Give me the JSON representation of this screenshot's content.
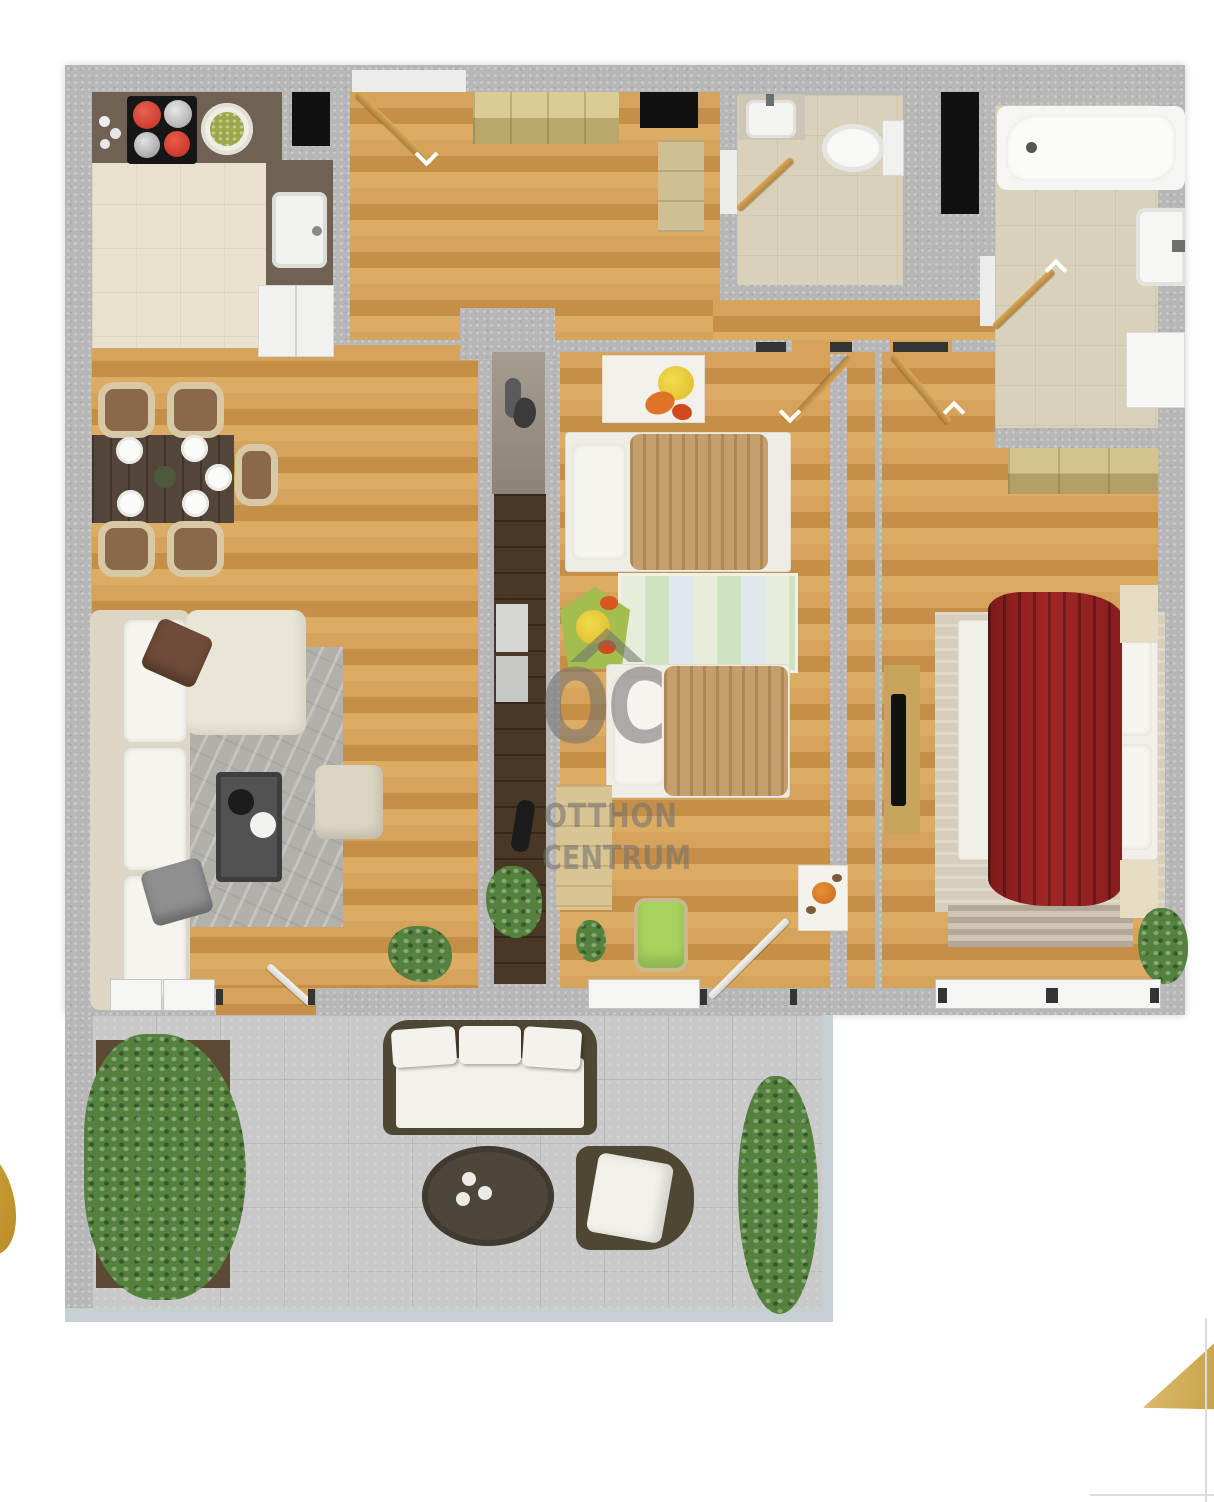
{
  "watermark": {
    "logo": "OC",
    "line1": "OTTHON",
    "line2": "CENTRUM"
  },
  "palette": {
    "wall_concrete": "#b7b7b7",
    "wood_floor": "#cf9c55",
    "kitchen_tile": "#e9e1cd",
    "bath_tile": "#d9d1ba",
    "terrace_concrete": "#c9c9c9",
    "counter_brown": "#6f6153",
    "sofa_beige": "#e9e5d7",
    "bed_blanket_red": "#8f1f1f",
    "kids_blanket_tan": "#c49e6c",
    "door_gold": "#c89a4e",
    "accent_gold": "#d0a744",
    "plant_green": "#54823e",
    "watermark_gray": "#6f6f6f"
  },
  "rooms": [
    {
      "name": "kitchen"
    },
    {
      "name": "dining-area"
    },
    {
      "name": "living-room"
    },
    {
      "name": "entrance-hall"
    },
    {
      "name": "wc"
    },
    {
      "name": "bathroom"
    },
    {
      "name": "inner-hallway"
    },
    {
      "name": "children-room"
    },
    {
      "name": "master-bedroom"
    },
    {
      "name": "storage-column"
    },
    {
      "name": "terrace"
    }
  ]
}
